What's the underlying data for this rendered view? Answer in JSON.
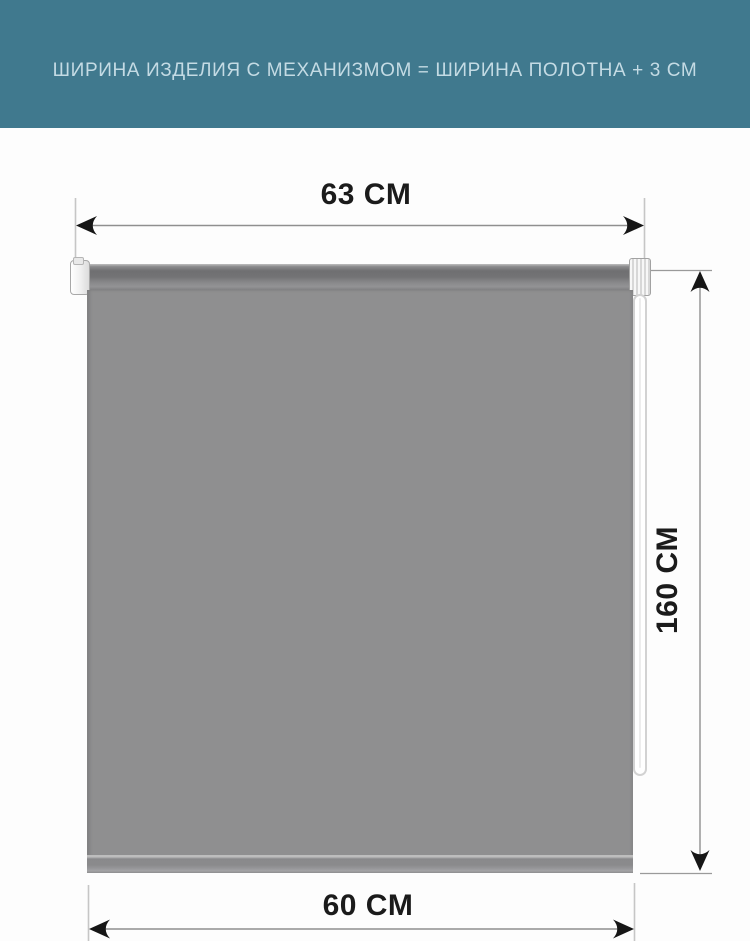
{
  "header": {
    "text": "ШИРИНА ИЗДЕЛИЯ С МЕХАНИЗМОМ = ШИРИНА ПОЛОТНА + 3 СМ"
  },
  "dimensions": {
    "top_width": "63 CM",
    "height": "160 CM",
    "bottom_width": "60 CM"
  },
  "product": {
    "type": "roller-blind",
    "parts": [
      "mounting-bracket",
      "roller-tube",
      "control-mechanism",
      "bead-chain",
      "fabric-panel",
      "bottom-weight-bar"
    ]
  },
  "colors": {
    "banner_bg": "#40798E",
    "banner_text": "#C4DBE4",
    "fabric": "#8F8F90",
    "tube_dark": "#6E6E70",
    "dim_text": "#1B1B1B",
    "dim_line": "#8F8F8F",
    "ext_line": "#C6C6C6",
    "arrow_fill": "#161616",
    "page_bg": "#FDFDFD"
  }
}
